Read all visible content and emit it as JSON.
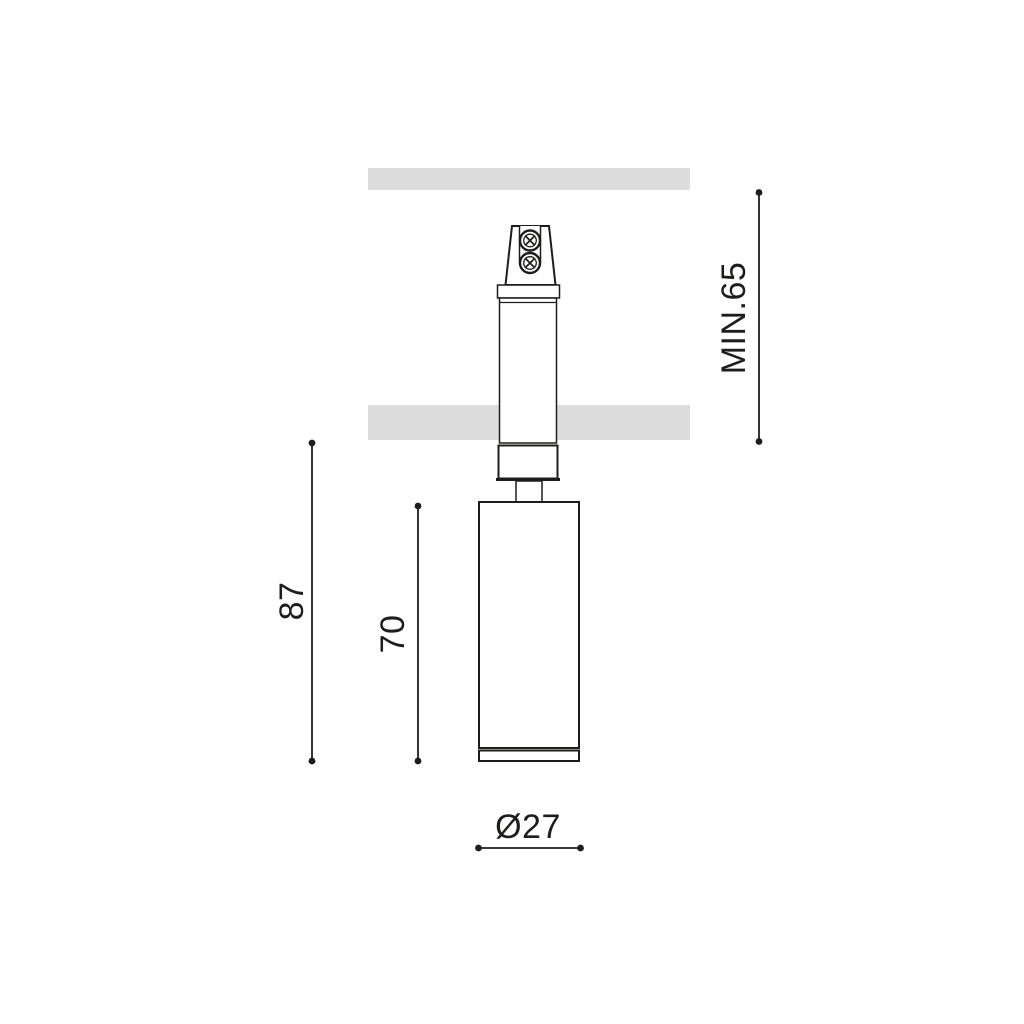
{
  "colors": {
    "background": "#ffffff",
    "panel": "#dcdcdc",
    "line": "#1d1d1b",
    "text": "#1d1d1b"
  },
  "drawing": {
    "dimensions": {
      "min_recess": {
        "label": "MIN.65"
      },
      "overall_height": {
        "label": "87"
      },
      "body_height": {
        "label": "70"
      },
      "diameter": {
        "label": "Ø27"
      }
    }
  }
}
